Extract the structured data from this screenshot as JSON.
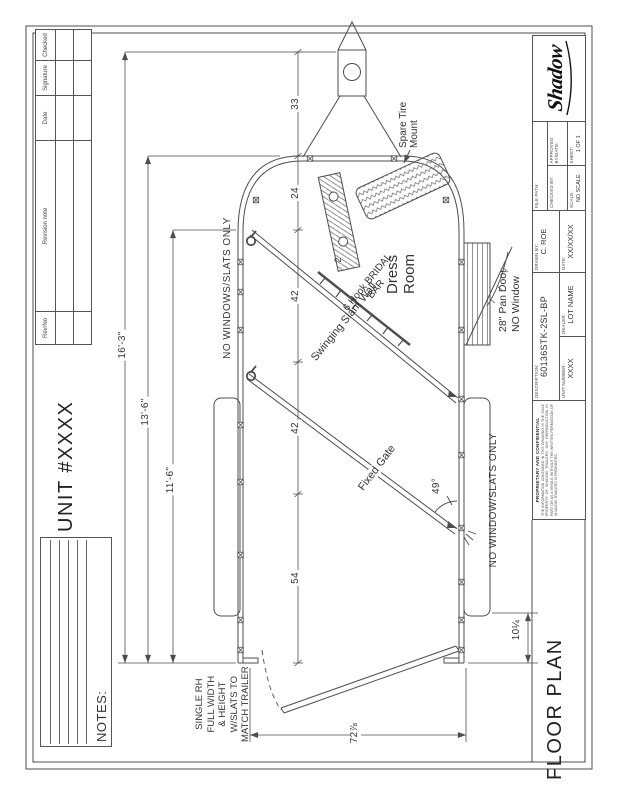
{
  "page": {
    "floor_plan_title": "FLOOR PLAN",
    "unit_title": "UNIT #XXXX",
    "notes_label": "NOTES:"
  },
  "revisions": {
    "headers": [
      "Rev/No",
      "Revision note",
      "Date",
      "Signature",
      "Checked"
    ]
  },
  "titleblock": {
    "logo": "Shadow",
    "file_path_label": "FILE PATH:",
    "drawn_label": "DRAWN BY:",
    "drawn": "C. ROE",
    "date_label": "DATE:",
    "date": "XX/XX/XX",
    "checked_label": "CHECKED BY:",
    "approved_label": "APPROVED BY/DATE:",
    "scale_label": "SCALE:",
    "scale": "NO SCALE",
    "sheet_label": "SHEET:",
    "sheet": "1 OF 1",
    "desc_label": "DESCRIPTION:",
    "desc": "60136STK-2SL-BP",
    "unitnum_label": "UNIT NUMBER:",
    "unitnum": "XXXX",
    "dealer_label": "DEALER:",
    "dealer": "LOT NAME",
    "prop_title": "PROPRIETARY AND CONFIDENTIAL",
    "prop_text": "THE INFORMATION CONTAINED IN THIS DRAWING IS THE SOLE PROPERTY OF SHADOW TRAILERS. ANY REPRODUCTION IN PART OR AS A WHOLE WITHOUT THE WRITTEN PERMISSION OF SHADOW TRAILERS IS PROHIBITED."
  },
  "plan": {
    "dress_room": [
      "Dress",
      "Room"
    ],
    "spare_tire": [
      "Spare Tire",
      "Mount"
    ],
    "pan_door": [
      "28\" Pan Door",
      "NO Window"
    ],
    "slant_wall": "Swinging Slant Wall",
    "bridal_bar": [
      "6 Hook BRIDAL",
      "BAR"
    ],
    "fixed_gate": "Fixed Gate",
    "no_windows_left": "NO WINDOWS/SLATS ONLY",
    "no_window_right": "NO WINDOW/SLATS ONLY",
    "rear_gate_note": [
      "SINGLE RH",
      "FULL WIDTH",
      "& HEIGHT",
      "W/SLATS TO",
      "MATCH TRAILER"
    ],
    "qty": "2",
    "dims": {
      "chain": [
        "33",
        "24",
        "42",
        "42",
        "54"
      ],
      "overall": "16'-3\"",
      "body": "13'-6\"",
      "interior": "11'-6\"",
      "rear_width": "72⅞",
      "rear_offset": "10¼",
      "gate_angle": "49°"
    }
  }
}
